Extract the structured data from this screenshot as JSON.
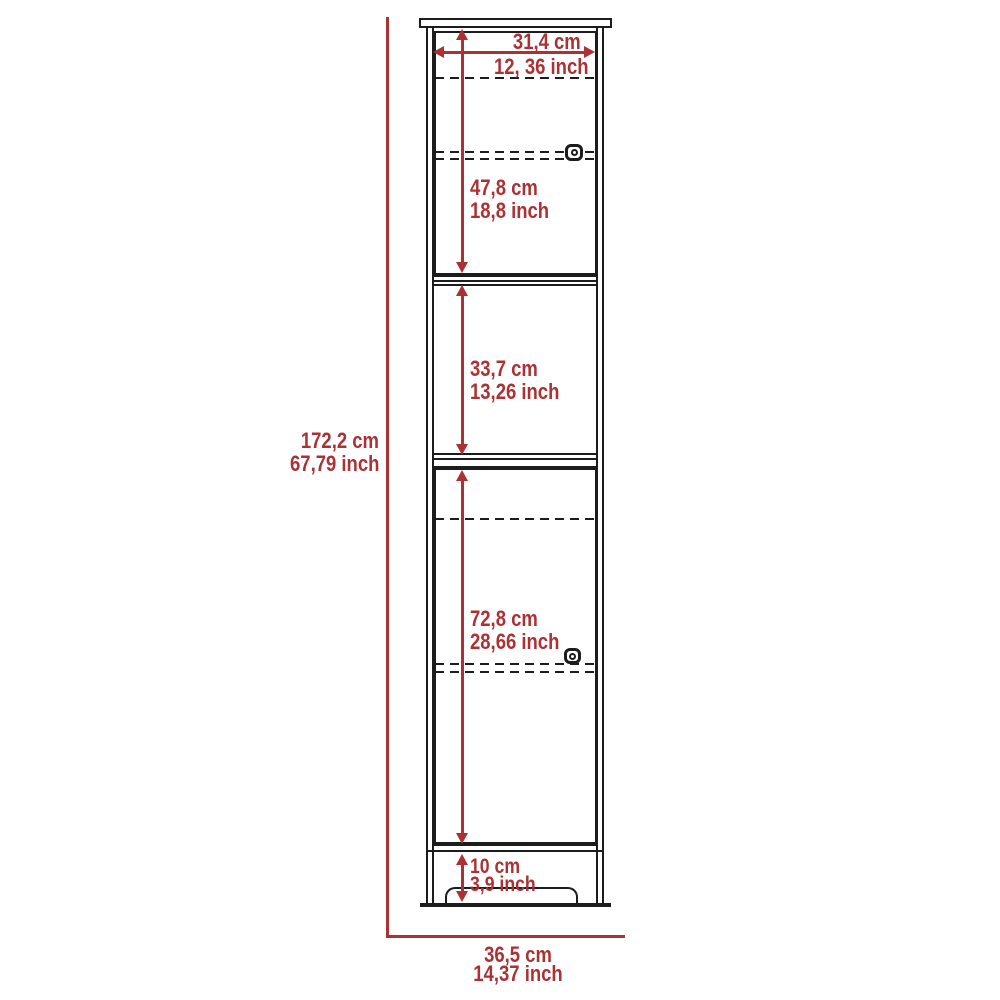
{
  "colors": {
    "dimension_red": "#ab3134",
    "line_black": "#1c1c1c",
    "background": "#ffffff"
  },
  "dims": {
    "height": {
      "cm": "172,2 cm",
      "inch": "67,79 inch"
    },
    "width": {
      "cm": "36,5 cm",
      "inch": "14,37 inch"
    },
    "inner_width": {
      "cm": "31,4 cm",
      "inch": "12, 36 inch"
    },
    "upper_door": {
      "cm": "47,8 cm",
      "inch": "18,8 inch"
    },
    "middle_section": {
      "cm": "33,7 cm",
      "inch": "13,26 inch"
    },
    "lower_door": {
      "cm": "72,8 cm",
      "inch": "28,66 inch"
    },
    "base": {
      "cm": "10 cm",
      "inch": "3,9 inch"
    }
  }
}
